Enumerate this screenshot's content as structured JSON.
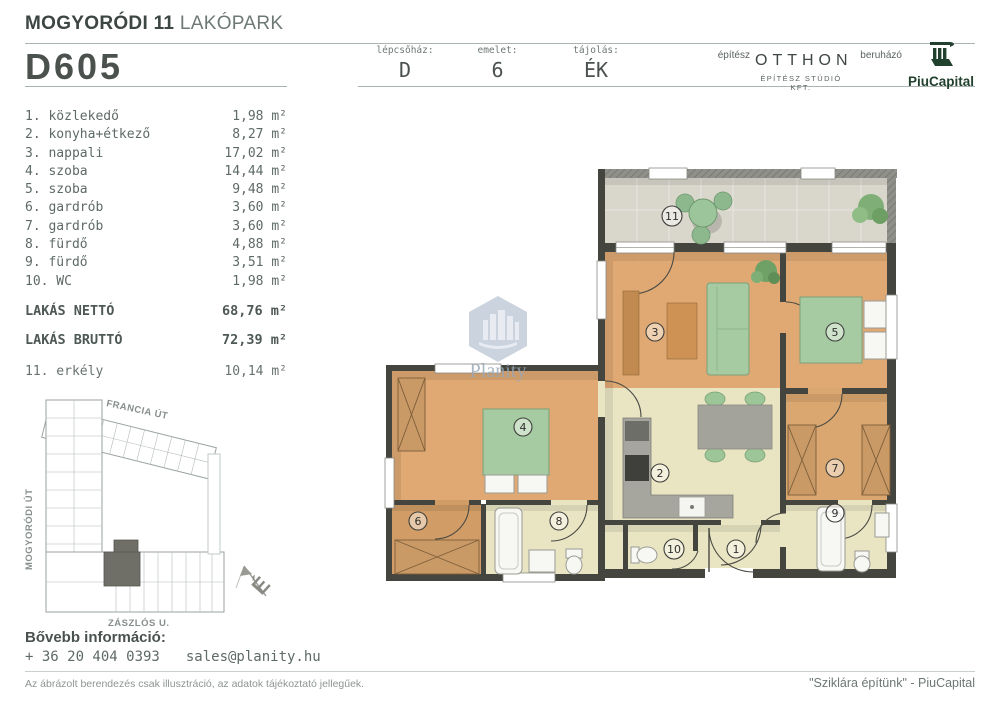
{
  "header": {
    "project_bold": "MOGYORÓDI 11",
    "project_light": "LAKÓPARK",
    "unit_id": "D605",
    "fields": [
      {
        "label": "lépcsőház:",
        "value": "D"
      },
      {
        "label": "emelet:",
        "value": "6"
      },
      {
        "label": "tájolás:",
        "value": "ÉK"
      }
    ],
    "architect_label": "építész",
    "architect_name": "OTTHON",
    "architect_sub": "ÉPÍTÉSZ STÚDIÓ KFT.",
    "developer_label": "beruházó",
    "developer_name": "PiuCapital"
  },
  "rooms": [
    {
      "label": "1. közlekedő",
      "area": "1,98 m²"
    },
    {
      "label": "2. konyha+étkező",
      "area": "8,27 m²"
    },
    {
      "label": "3. nappali",
      "area": "17,02 m²"
    },
    {
      "label": "4. szoba",
      "area": "14,44 m²"
    },
    {
      "label": "5. szoba",
      "area": "9,48 m²"
    },
    {
      "label": "6. gardrób",
      "area": "3,60 m²"
    },
    {
      "label": "7. gardrób",
      "area": "3,60 m²"
    },
    {
      "label": "8. fürdő",
      "area": "4,88 m²"
    },
    {
      "label": "9. fürdő",
      "area": "3,51 m²"
    },
    {
      "label": "10. WC",
      "area": "1,98 m²"
    }
  ],
  "totals": [
    {
      "label": "LAKÁS NETTÓ",
      "area": "68,76 m²"
    },
    {
      "label": "LAKÁS BRUTTÓ",
      "area": "72,39 m²"
    }
  ],
  "extra": {
    "label": "11. erkély",
    "area": "10,14 m²"
  },
  "floor_plan": {
    "labels": [
      "1",
      "2",
      "3",
      "4",
      "5",
      "6",
      "7",
      "8",
      "9",
      "10",
      "11"
    ],
    "watermark": "Planity"
  },
  "site_plan": {
    "streets": [
      "FRANCIA ÚT",
      "MOGYORÓDI ÚT",
      "ZÁSZLÓS U."
    ],
    "compass": "É"
  },
  "contact": {
    "heading": "Bővebb információ:",
    "phone": "+ 36 20 404 0393",
    "email": "sales@planity.hu"
  },
  "footer": {
    "disclaimer": "Az ábrázolt berendezés csak illusztráció, az adatok tájékoztató jellegűek.",
    "slogan": "\"Sziklára építünk\" - PiuCapital"
  },
  "colors": {
    "logo_green": "#22402e",
    "wall": "#45453f",
    "wood_floor": "#e0a974",
    "light_floor": "#e9e5c3",
    "balcony_tile": "#d9d6cc",
    "furniture_green": "#a6cba2",
    "watermark_blue": "#b6c3d2",
    "text_dark": "#4b524e",
    "text_mid": "#5e6a66"
  }
}
